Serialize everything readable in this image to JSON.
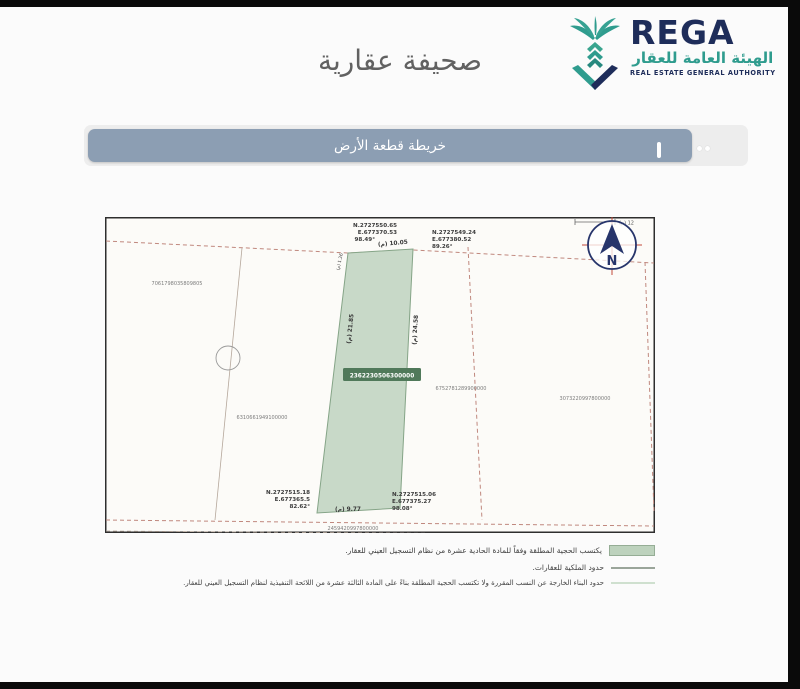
{
  "page": {
    "title": "صحيفة عقارية"
  },
  "logo": {
    "name": "REGA",
    "arabic_name": "الهيئة العامة للعقار",
    "english_name": "REAL ESTATE GENERAL AUTHORITY",
    "teal": "#2f9c8e",
    "navy": "#1e2d5a"
  },
  "section_bar": {
    "label": "خريطة قطعة الأرض",
    "background": "#8c9eb3"
  },
  "map": {
    "compass_letter": "N",
    "scale_label": "(م) 12",
    "subject_parcel": {
      "number": "2362230506300000",
      "fill_color": "#c8d9c8",
      "highlight_color": "#50795a"
    },
    "dimensions": {
      "top": "(م) 10.05",
      "bottom": "(م) 9.77",
      "left": "(م) 21.85",
      "right": "(م) 24.58",
      "notch": "(م) 1.26"
    },
    "corners": {
      "top_left": {
        "n": "N.2727550.65",
        "e": "E.677370.53",
        "angle": "98.49°"
      },
      "top_right": {
        "n": "N.2727549.24",
        "e": "E.677380.52",
        "angle": "89.26°"
      },
      "bottom_left": {
        "n": "N.2727515.18",
        "e": "E.677365.5",
        "angle": "82.62°"
      },
      "bottom_right": {
        "n": "N.2727515.06",
        "e": "E.677375.27",
        "angle": "98.08°"
      }
    },
    "neighbor_parcels": {
      "west": "7061798035809805",
      "southwest": "6310661949100000",
      "east_inner": "6752781289900000",
      "east_outer": "3073220997800000",
      "south": "2459420997800000"
    },
    "boundary_dash_color": "#c0887e"
  },
  "legend": {
    "items": [
      {
        "swatch": "green-fill",
        "text": "يكتسب الحجية المطلقة وفقاً للمادة الحادية عشرة من نظام التسجيل العيني للعقار."
      },
      {
        "swatch": "gray-line",
        "text": "حدود الملكية للعقارات."
      },
      {
        "swatch": "light-green-line",
        "text": "حدود البناء الخارجة عن النسب المقررة ولا تكتسب الحجية المطلقة بناءً على المادة الثالثة عشرة من اللائحة التنفيذية لنظام التسجيل العيني للعقار."
      }
    ]
  }
}
